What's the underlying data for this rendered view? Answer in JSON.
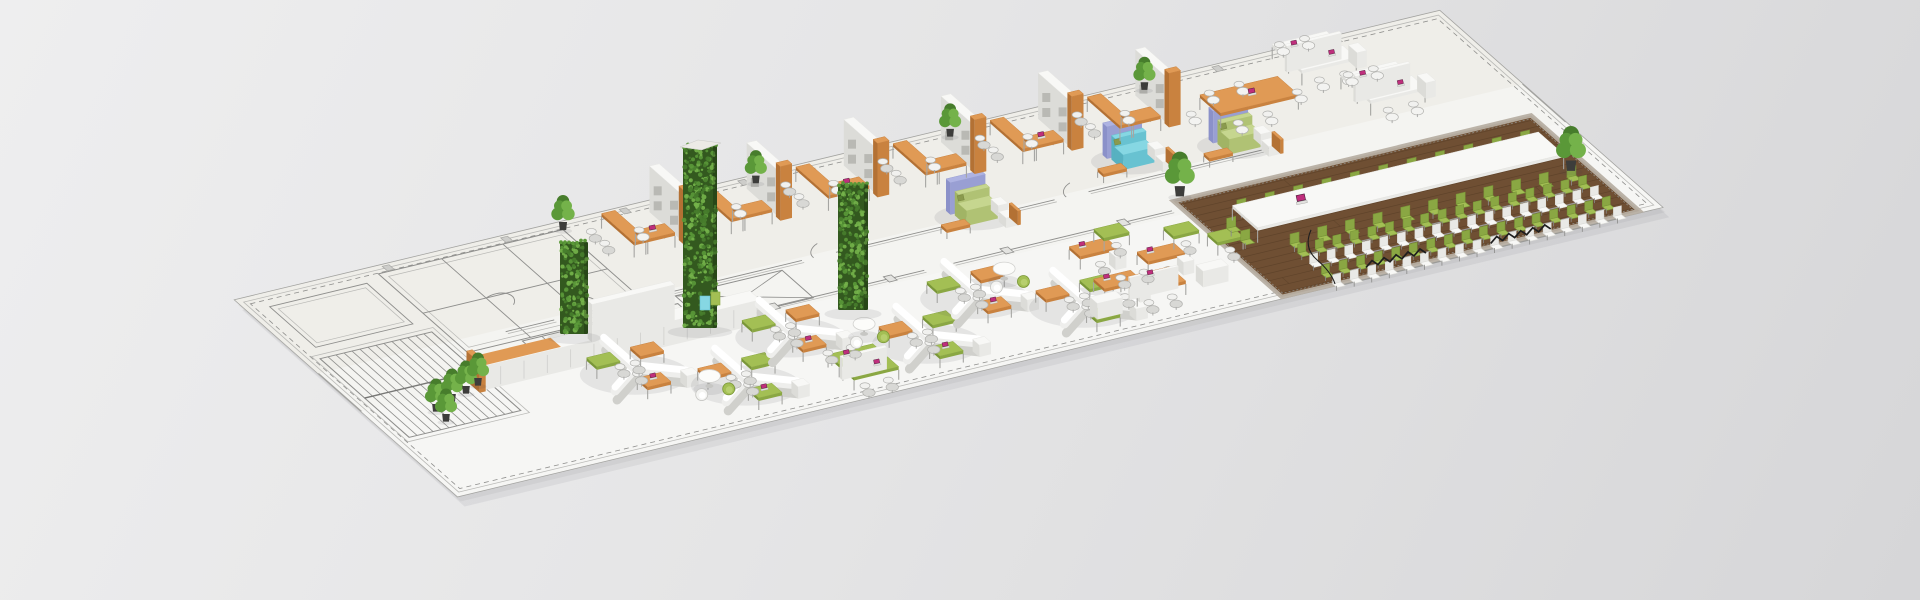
{
  "scene": {
    "projection": {
      "origin": [
        235,
        300
      ],
      "u": [
        0.9715,
        -0.2333
      ],
      "v": [
        0.742,
        0.655
      ]
    },
    "slab": {
      "length": 1240,
      "depth": 300,
      "top_band_depth": 112
    },
    "colors": {
      "floor": "#f4f4f1",
      "floor_top_band": "#efeee9",
      "floor_bottom_band": "#f6f6f4",
      "line": "#8f8f8d",
      "line_light": "#b9b9b6",
      "wood": "#6f4f33",
      "wood_line": "#5c4129",
      "wood_border": "#b7afa3",
      "leaf_base": "#33591f",
      "leaf_specks": [
        "#477d2c",
        "#5a9838",
        "#74b24a"
      ],
      "laptop_screen": "#bf2e7c",
      "laptop_frame": "#4a1d38",
      "chair_gray": "#d8d8d5",
      "chair_white": "#f3f3f1",
      "chair_line": "#b2b2af",
      "cable": "#1e1e1e",
      "shadow": "rgba(70,70,75,0.10)",
      "pot": "#3d3d3b"
    },
    "materials": {
      "orange": [
        "#e09a55",
        "#c9823f",
        "#b37134"
      ],
      "white": [
        "#f8f8f6",
        "#e9e9e6",
        "#dcdcd8"
      ],
      "green": [
        "#a3bf54",
        "#8aa743",
        "#799638"
      ],
      "cyan": [
        "#86d7e3",
        "#68c2d1",
        "#57b1c1"
      ],
      "lilac": [
        "#aeb3e2",
        "#999fd3",
        "#8b91c9"
      ],
      "sofa_green": [
        "#c6d68f",
        "#b0c274",
        "#a1b465"
      ],
      "olive": [
        "#8a9a4e",
        "#78873f",
        "#6a7a36"
      ]
    },
    "cad": {
      "stairs": {
        "x": 15,
        "y": 95,
        "w": 115,
        "d": 120,
        "treads": 15
      },
      "west_room": [
        22,
        18,
        100,
        62
      ],
      "rooms_rect": [
        140,
        10,
        190,
        120
      ],
      "room_partitions_x": [
        205,
        268
      ],
      "stalls": {
        "x": 195,
        "y": 132,
        "w": 160,
        "d": 36,
        "dividers": 7
      },
      "cross_room": [
        360,
        122,
        110,
        42
      ],
      "corridor1": {
        "y": 116,
        "segments": [
          [
            190,
            240
          ],
          [
            275,
            495
          ],
          [
            530,
            755
          ],
          [
            790,
            985
          ]
        ]
      },
      "corridor2": {
        "y": 163,
        "segments": [
          [
            115,
            585
          ],
          [
            615,
            840
          ]
        ]
      },
      "junctions_x": [
        190,
        310,
        430,
        550,
        670,
        790
      ],
      "door_arcs_x": [
        252,
        507,
        767
      ],
      "columns": {
        "x0": 150,
        "pitch": 122,
        "count": 9
      }
    },
    "offices": {
      "x0": 340,
      "pitch": 100,
      "count": 6,
      "plants_at": [
        1,
        3,
        5
      ]
    },
    "meeting_table": {
      "x": 955,
      "y": 50,
      "w": 80,
      "d": 28
    },
    "bench_clusters": [
      [
        1060,
        10
      ],
      [
        1088,
        66
      ]
    ],
    "sofas": [
      {
        "x": 660,
        "y": 106,
        "kind": "green"
      },
      {
        "x": 838,
        "y": 84,
        "kind": "cyan"
      },
      {
        "x": 938,
        "y": 96,
        "kind": "green"
      }
    ],
    "green_walls": [
      {
        "x": 560,
        "y": 242,
        "w": 28,
        "h": 92,
        "cap": false
      },
      {
        "x": 683,
        "y": 146,
        "w": 34,
        "h": 182,
        "cap": true
      },
      {
        "x": 838,
        "y": 184,
        "w": 30,
        "h": 126,
        "cap": false
      }
    ],
    "white_wall": {
      "x": 250,
      "y": 148,
      "len": 85,
      "h": 38
    },
    "cabinet_row": {
      "x": 118,
      "y": 166,
      "len": 285,
      "d": 14,
      "h": 24,
      "orange_len": 80
    },
    "lockers": [
      {
        "sx": 700,
        "sy": 296,
        "w": 10,
        "h": 14,
        "mat": "cyan"
      },
      {
        "sx": 711,
        "sy": 292,
        "w": 9,
        "h": 13,
        "mat": "green"
      }
    ],
    "plant_row": [
      [
        436,
        404
      ],
      [
        452,
        394
      ],
      [
        466,
        386
      ],
      [
        478,
        378
      ],
      [
        446,
        414
      ]
    ],
    "standalone_plants": [
      [
        563,
        222
      ]
    ],
    "hex_clusters": [
      [
        255,
        205
      ],
      [
        335,
        250
      ],
      [
        415,
        205
      ],
      [
        520,
        252
      ],
      [
        600,
        212
      ],
      [
        680,
        254
      ]
    ],
    "green_bench": {
      "x": 418,
      "y": 252
    },
    "round_tables": [
      [
        305,
        240
      ],
      [
        478,
        222
      ],
      [
        642,
        196
      ]
    ],
    "open_desks": {
      "straight": [
        [
          712,
          192
        ],
        [
          762,
          218
        ],
        [
          702,
          238
        ]
      ],
      "corner_green": [
        [
          748,
          178
        ],
        [
          806,
          196
        ],
        [
          836,
          216
        ]
      ],
      "orange_bench": [
        724,
        246
      ],
      "cabinets": [
        [
          795,
          254
        ],
        [
          680,
          262
        ]
      ]
    },
    "wood_area": {
      "x": 850,
      "y": 152,
      "w": 368,
      "d": 146,
      "plank_gap": 9
    },
    "conference": {
      "table": {
        "x": 880,
        "y": 192,
        "len": 315,
        "d": 34,
        "h": 15
      },
      "chairs_north": {
        "y": 181,
        "x1": 893,
        "x2": 1185,
        "n": 11
      },
      "chairs_south": {
        "y": 237,
        "x1": 905,
        "x2": 1190,
        "n": 11
      },
      "chairs_west": [
        [
          868,
          200
        ],
        [
          868,
          219
        ]
      ],
      "beam_rows": [
        {
          "y": 250,
          "c": "green"
        },
        {
          "y": 266,
          "c": "white"
        },
        {
          "y": 282,
          "c": "green"
        },
        {
          "y": 297,
          "c": "white"
        }
      ],
      "beam_x": {
        "x1": 903,
        "x2": 1192,
        "n": 17
      }
    },
    "zigzags": [
      [
        945,
        287
      ],
      [
        1068,
        294
      ]
    ],
    "tall_plants": [
      [
        858,
        150
      ],
      [
        1198,
        232
      ]
    ]
  }
}
